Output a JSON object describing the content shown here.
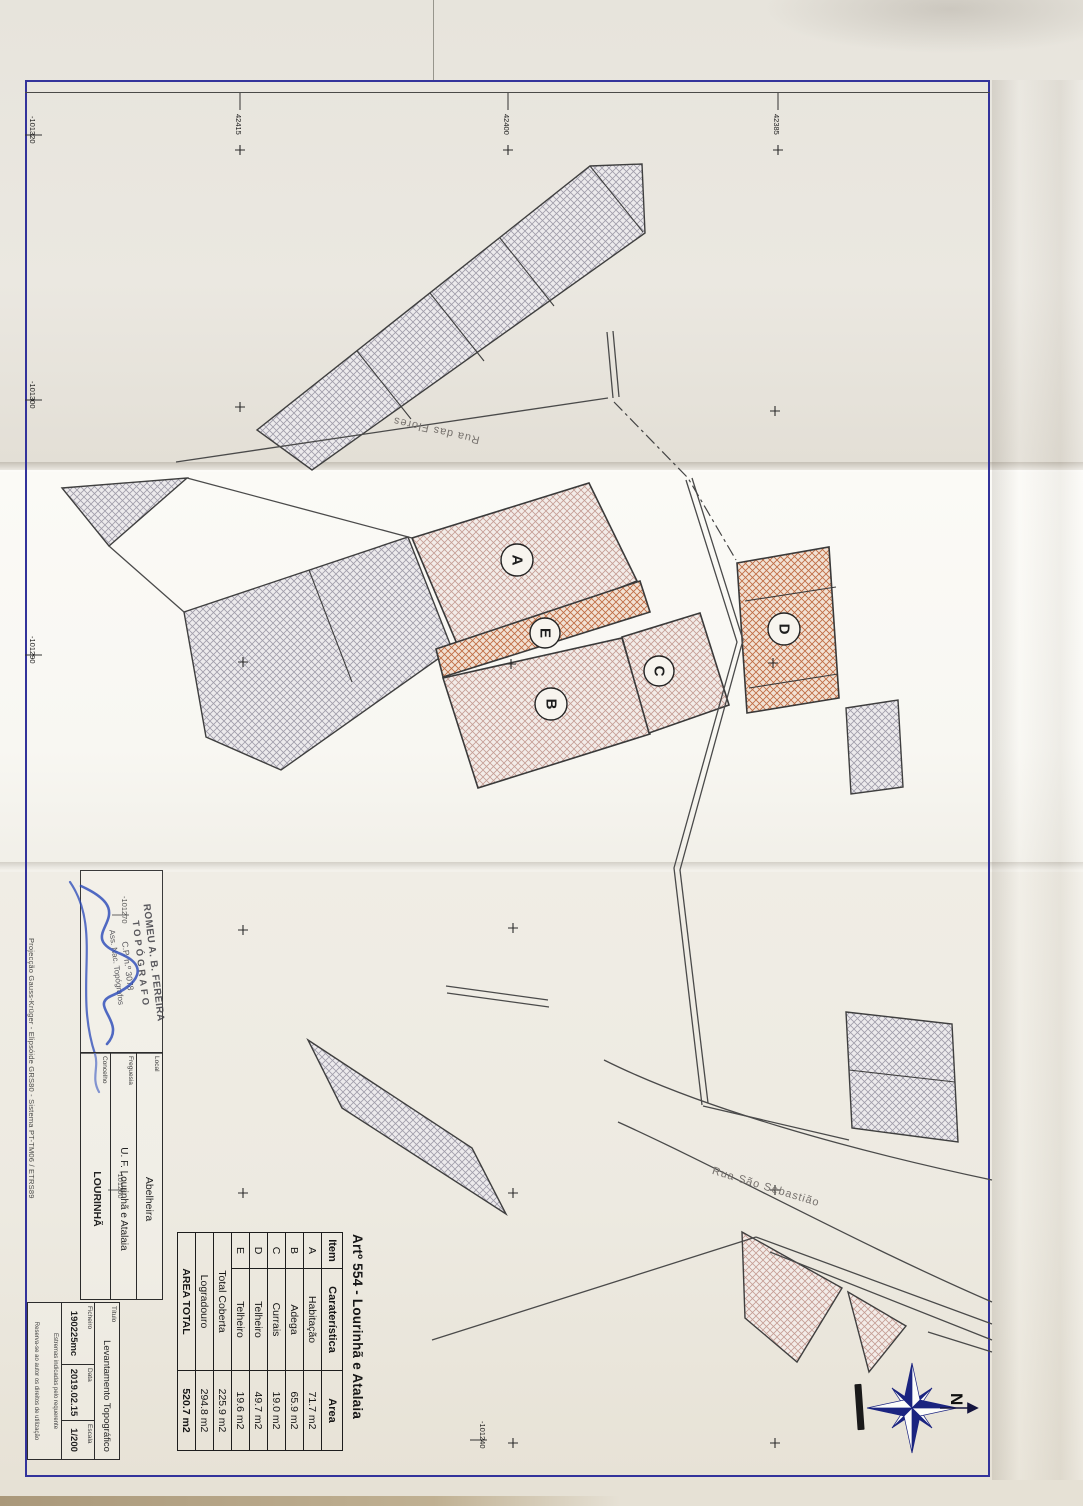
{
  "heading": "Artº 554 - Lourinhã e Atalaia",
  "areas": {
    "headers": [
      "Item",
      "Caraterística",
      "Area"
    ],
    "rows": [
      {
        "item": "A",
        "name": "Habitação",
        "area": "71.7 m2"
      },
      {
        "item": "B",
        "name": "Adega",
        "area": "65.9 m2"
      },
      {
        "item": "C",
        "name": "Currais",
        "area": "19.0 m2"
      },
      {
        "item": "D",
        "name": "Telheiro",
        "area": "49.7 m2"
      },
      {
        "item": "E",
        "name": "Telheiro",
        "area": "19.6 m2"
      }
    ],
    "summary": [
      {
        "label": "Total Coberta",
        "value": "225.9 m2"
      },
      {
        "label": "Logradouro",
        "value": "294.8 m2"
      },
      {
        "label": "AREA TOTAL",
        "value": "520.7 m2"
      }
    ]
  },
  "title_block": {
    "stamp_name": "ROMEU A. B. FEREIRA",
    "stamp_role": "TOPÓGRAFO",
    "stamp_cp": "C.P. n.º 3078",
    "stamp_assoc": "Ass. Nac. Topógrafos",
    "projection": "Projecção Gauss-Krüger - Elipsóide GRS80 - Sistema PT-TM06 / ETRS89",
    "local_label": "Local",
    "local_value": "Abelheira",
    "freguesia_label": "Freguesia",
    "freguesia_value": "U. F. Lourinhã e Atalaia",
    "concelho_label": "Concelho",
    "concelho_value": "LOURINHÃ",
    "titulo_label": "Título",
    "titulo_value": "Levantamento Topográfico",
    "ficheiro_label": "Ficheiro",
    "ficheiro_value": "190225mc",
    "data_label": "Data",
    "data_value": "2019.02.15",
    "escala_label": "Escala",
    "escala_value": "1/200",
    "note1": "Estremas indicadas pelo requerente",
    "note2": "Reserva-se ao autor os direitos de utilização"
  },
  "map": {
    "streets": {
      "flores": "Rua das Flores",
      "sebastiao": "Rua São Sebastião"
    },
    "buildings": {
      "a": "A",
      "b": "B",
      "c": "C",
      "d": "D",
      "e": "E"
    },
    "grid_top": [
      "42415",
      "42400",
      "42385"
    ],
    "grid_left": [
      "-101320",
      "-101300",
      "-101290",
      "-101270",
      "-101260",
      "-101240"
    ],
    "north": "N"
  },
  "colors": {
    "frame_blue": "#33339b",
    "hatch_pink": "#c59d94",
    "hatch_orange": "#bf6d45",
    "hatch_gray": "#a09daa",
    "signature_blue": "#2747b8",
    "compass_navy": "#1b2480"
  }
}
